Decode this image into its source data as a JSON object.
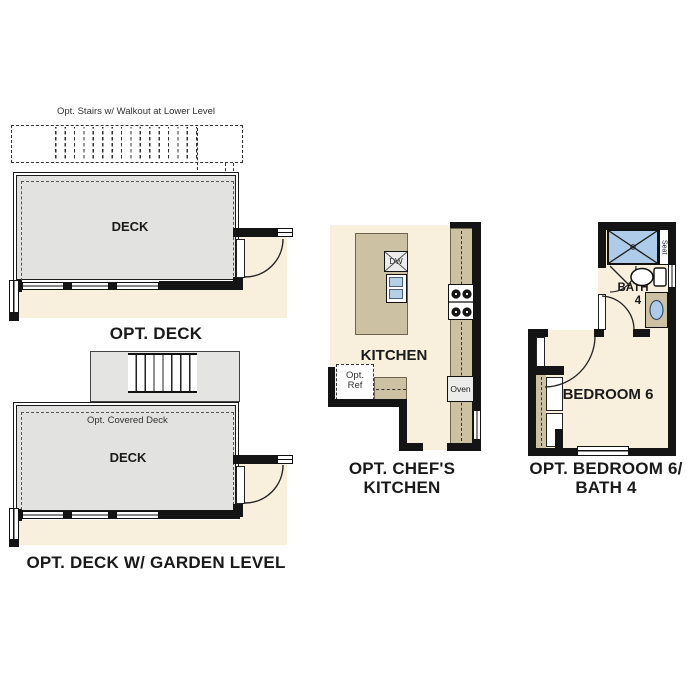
{
  "colors": {
    "deck_fill": "#e2e2e0",
    "interior_fill": "#f8efdd",
    "counter_tan": "#cdc1a4",
    "fixture_blue": "#aecbe9",
    "wall_black": "#141414"
  },
  "sections": {
    "opt_deck": {
      "stairs_note": "Opt. Stairs w/ Walkout at Lower Level",
      "room_label": "DECK",
      "caption": "OPT. DECK"
    },
    "opt_deck_garden": {
      "covered_note": "Opt. Covered Deck",
      "room_label": "DECK",
      "caption": "OPT. DECK W/ GARDEN LEVEL"
    },
    "opt_chefs_kitchen": {
      "room_label": "KITCHEN",
      "dishwasher_label": "DW",
      "ref_line1": "Opt.",
      "ref_line2": "Ref",
      "oven_label": "Oven",
      "caption_line1": "OPT. CHEF'S",
      "caption_line2": "KITCHEN"
    },
    "opt_bedroom6_bath4": {
      "bath_line1": "BATH",
      "bath_line2": "4",
      "seat_label": "Seat",
      "room_label": "BEDROOM 6",
      "caption_line1": "OPT. BEDROOM 6/",
      "caption_line2": "BATH 4"
    }
  }
}
